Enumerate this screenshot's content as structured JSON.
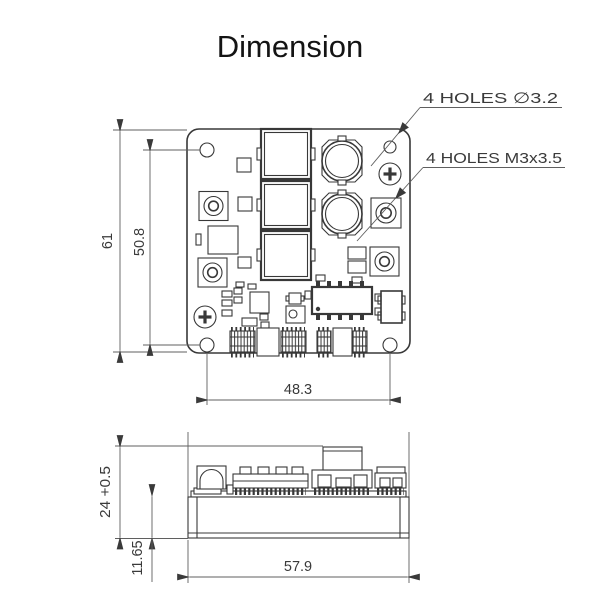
{
  "title": "Dimension",
  "colors": {
    "line": "#383838",
    "background": "#ffffff"
  },
  "top_view": {
    "callouts": {
      "through_holes": "4 HOLES ∅3.2",
      "threaded_holes": "4 HOLES M3x3.5"
    },
    "dimensions": {
      "board_height": "61",
      "hole_spacing_vertical": "50.8",
      "hole_spacing_horizontal": "48.3"
    }
  },
  "side_view": {
    "dimensions": {
      "overall_height": "24 +0.5",
      "base_height": "11.65",
      "board_width": "57.9"
    }
  }
}
